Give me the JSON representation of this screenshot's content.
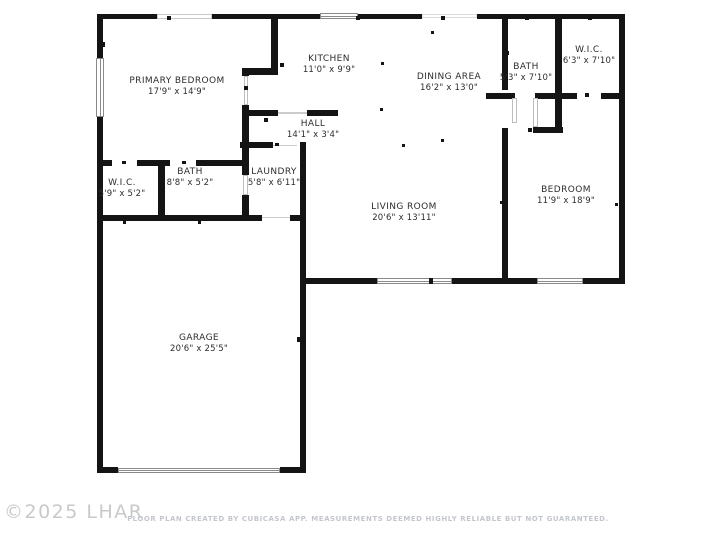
{
  "watermark": {
    "text": "©2025 LHAR"
  },
  "footer": {
    "text": "FLOOR PLAN CREATED BY CUBICASA APP. MEASUREMENTS DEEMED HIGHLY RELIABLE BUT NOT GUARANTEED."
  },
  "colors": {
    "background": "#ffffff",
    "wall": "#141414",
    "window_frame": "#8a8a8a",
    "faint_line": "#cccccc",
    "label_text": "#2d2d2d",
    "watermark_text": "#c9c9c9",
    "footer_text": "#c3c7cd"
  },
  "rooms": [
    {
      "id": "primary-bedroom",
      "name": "PRIMARY BEDROOM",
      "dims": "17'9\" x 14'9\"",
      "cx": 177,
      "cy": 87
    },
    {
      "id": "kitchen",
      "name": "KITCHEN",
      "dims": "11'0\" x 9'9\"",
      "cx": 329,
      "cy": 65
    },
    {
      "id": "dining-area",
      "name": "DINING AREA",
      "dims": "16'2\" x 13'0\"",
      "cx": 449,
      "cy": 83
    },
    {
      "id": "bath-top",
      "name": "BATH",
      "dims": "5'3\" x 7'10\"",
      "cx": 526,
      "cy": 73
    },
    {
      "id": "wic-top",
      "name": "W.I.C.",
      "dims": "6'3\" x 7'10\"",
      "cx": 589,
      "cy": 56
    },
    {
      "id": "hall",
      "name": "HALL",
      "dims": "14'1\" x 3'4\"",
      "cx": 313,
      "cy": 130
    },
    {
      "id": "laundry",
      "name": "LAUNDRY",
      "dims": "5'8\" x 6'11\"",
      "cx": 274,
      "cy": 178
    },
    {
      "id": "wic-bottom",
      "name": "W.I.C.",
      "dims": "5'9\" x 5'2\"",
      "cx": 122,
      "cy": 189
    },
    {
      "id": "bath-bottom",
      "name": "BATH",
      "dims": "8'8\" x 5'2\"",
      "cx": 190,
      "cy": 178
    },
    {
      "id": "living-room",
      "name": "LIVING ROOM",
      "dims": "20'6\" x 13'11\"",
      "cx": 404,
      "cy": 213
    },
    {
      "id": "bedroom",
      "name": "BEDROOM",
      "dims": "11'9\" x 18'9\"",
      "cx": 566,
      "cy": 196
    },
    {
      "id": "garage",
      "name": "GARAGE",
      "dims": "20'6\" x 25'5\"",
      "cx": 199,
      "cy": 344
    }
  ],
  "geometry": {
    "walls": [
      [
        97,
        13.5,
        60,
        5.5
      ],
      [
        212,
        13.5,
        108,
        5.5
      ],
      [
        358,
        13.5,
        64,
        5.5
      ],
      [
        477,
        13.5,
        148,
        5.5
      ],
      [
        97,
        13.5,
        6,
        44.5
      ],
      [
        97,
        117,
        6,
        356
      ],
      [
        619,
        13.5,
        6,
        270
      ],
      [
        299.5,
        277.5,
        77.5,
        6
      ],
      [
        452,
        277.5,
        85,
        6
      ],
      [
        583,
        277.5,
        42,
        6
      ],
      [
        97,
        467,
        21,
        6
      ],
      [
        280,
        467,
        25.5,
        6
      ],
      [
        97,
        214.5,
        165,
        6
      ],
      [
        290,
        214.5,
        16,
        6
      ],
      [
        97,
        159.5,
        15,
        6
      ],
      [
        137,
        159.5,
        33,
        6
      ],
      [
        196,
        159.5,
        52,
        6
      ],
      [
        158,
        159.5,
        6.5,
        55
      ],
      [
        242,
        142,
        6.5,
        33
      ],
      [
        242,
        195,
        6.5,
        25.5
      ],
      [
        240,
        142,
        33,
        6
      ],
      [
        299.5,
        142,
        6.5,
        331
      ],
      [
        242,
        109.5,
        36,
        6
      ],
      [
        307,
        109.5,
        31,
        6
      ],
      [
        270.5,
        17,
        7,
        57
      ],
      [
        242,
        68,
        36,
        6.5
      ],
      [
        242,
        68,
        6.5,
        8
      ],
      [
        242,
        105,
        6.5,
        43
      ],
      [
        501.5,
        17,
        6.5,
        73
      ],
      [
        486,
        92.5,
        29,
        6
      ],
      [
        535,
        92.5,
        42,
        6
      ],
      [
        601,
        92.5,
        20,
        6
      ],
      [
        555,
        17,
        7,
        113
      ],
      [
        533,
        126.5,
        30,
        6.5
      ],
      [
        501.5,
        128,
        6.5,
        155.5
      ]
    ],
    "windows": [
      {
        "x": 157,
        "y": 13.5,
        "w": 55,
        "h": 5.5,
        "style": "faint",
        "divider": "none"
      },
      {
        "x": 320,
        "y": 12.5,
        "w": 38,
        "h": 6.5,
        "style": "solid",
        "divider": "h"
      },
      {
        "x": 422,
        "y": 14,
        "w": 55,
        "h": 4,
        "style": "vfaint",
        "divider": "none"
      },
      {
        "x": 95.5,
        "y": 58,
        "w": 8,
        "h": 59,
        "style": "solid",
        "divider": "v"
      },
      {
        "x": 377,
        "y": 277.5,
        "w": 75,
        "h": 6.5,
        "style": "solid",
        "divider": "h"
      },
      {
        "x": 537,
        "y": 277.5,
        "w": 46,
        "h": 6.5,
        "style": "solid",
        "divider": "h"
      },
      {
        "x": 118,
        "y": 467.5,
        "w": 162,
        "h": 5,
        "style": "solid",
        "divider": "h"
      }
    ],
    "door_leaves": [
      [
        243.5,
        76,
        4.5,
        29
      ],
      [
        512,
        98,
        5,
        25
      ],
      [
        533,
        98,
        4.5,
        29
      ],
      [
        243,
        175,
        5,
        20
      ]
    ],
    "thresholds": [
      [
        262,
        216.5,
        28,
        1.5
      ],
      [
        278,
        112,
        29,
        1.5
      ],
      [
        273,
        144.5,
        24,
        1.5
      ]
    ],
    "ticks": [
      [
        167,
        16,
        4,
        4
      ],
      [
        356,
        16,
        4,
        4
      ],
      [
        441,
        16,
        4,
        4
      ],
      [
        100,
        42,
        5,
        5
      ],
      [
        244,
        86,
        4,
        4
      ],
      [
        280,
        63,
        4,
        4
      ],
      [
        264,
        118,
        4,
        4
      ],
      [
        381,
        62,
        3,
        3
      ],
      [
        431,
        31,
        3,
        3
      ],
      [
        380,
        108,
        3,
        3
      ],
      [
        402,
        144,
        3,
        3
      ],
      [
        441,
        139,
        3,
        3
      ],
      [
        525,
        17,
        4,
        3
      ],
      [
        588,
        17,
        4,
        3
      ],
      [
        505,
        51,
        4,
        4
      ],
      [
        556,
        51,
        4,
        4
      ],
      [
        585,
        93,
        4,
        4
      ],
      [
        528,
        128,
        4,
        4
      ],
      [
        500,
        201,
        3,
        3
      ],
      [
        615,
        203,
        3,
        3
      ],
      [
        122,
        161,
        4,
        3
      ],
      [
        182,
        161,
        4,
        3
      ],
      [
        123,
        221,
        3,
        3
      ],
      [
        198,
        221,
        3,
        3
      ],
      [
        100,
        337,
        3,
        5
      ],
      [
        297,
        337,
        3,
        5
      ],
      [
        275,
        143,
        4,
        3
      ],
      [
        429,
        277.5,
        4,
        6.5
      ]
    ]
  }
}
